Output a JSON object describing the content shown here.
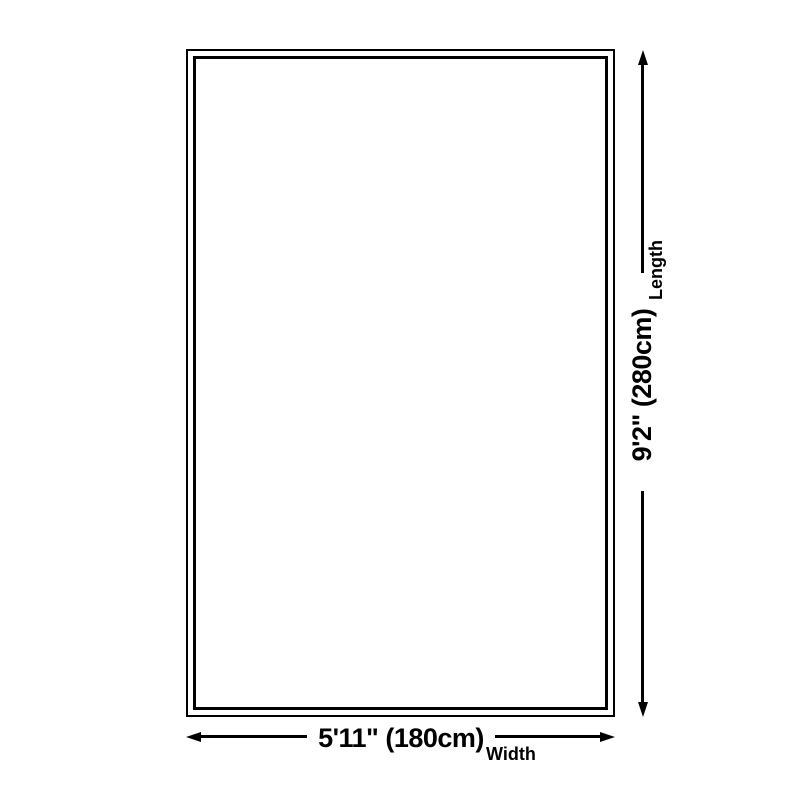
{
  "diagram": {
    "kind": "product-size-diagram",
    "background_color": "#ffffff",
    "line_color": "#000000",
    "product_shape": "rectangle-double-outline",
    "width_dimension": {
      "value": "5'11\" (180cm)",
      "label": "Width",
      "feet_inches": "5'11\"",
      "centimeters": 180
    },
    "length_dimension": {
      "value": "9'2\" (280cm)",
      "label": "Length",
      "feet_inches": "9'2\"",
      "centimeters": 280
    }
  }
}
